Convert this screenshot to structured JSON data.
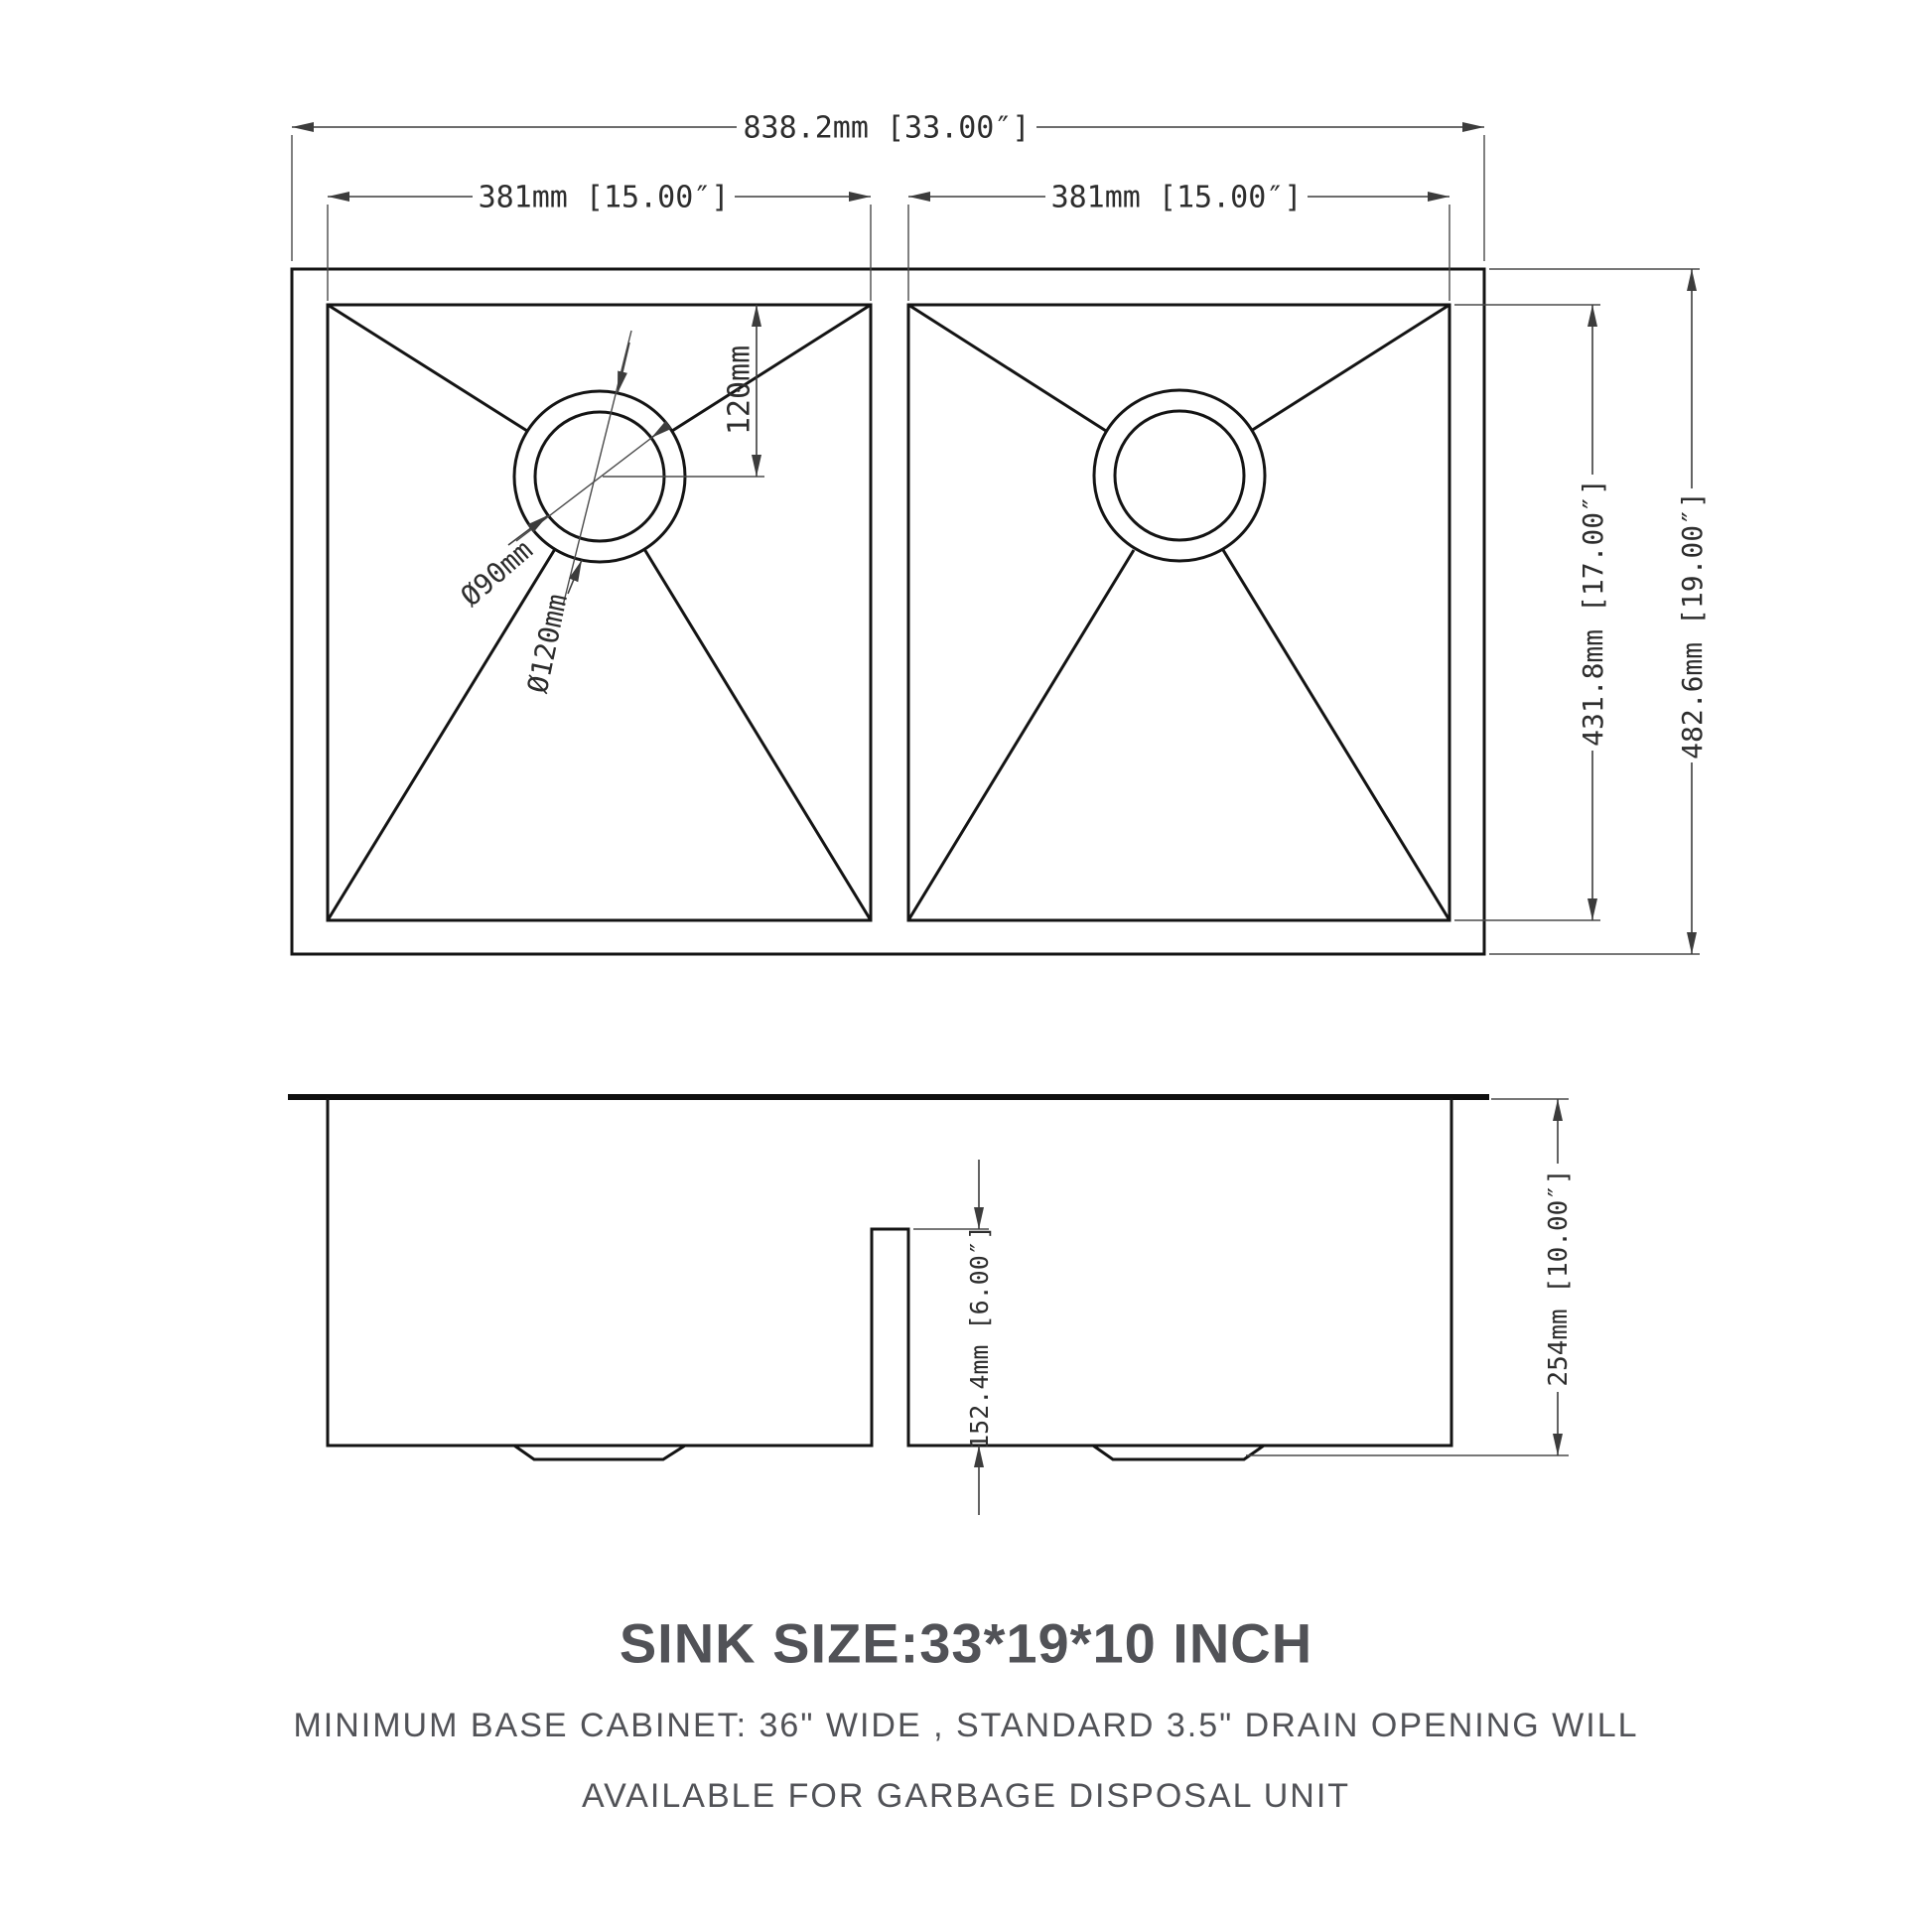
{
  "drawing_type": "sink technical drawing",
  "top_view": {
    "overall_width": "838.2mm [33.00″]",
    "bowl_width_left": "381mm [15.00″]",
    "bowl_width_right": "381mm [15.00″]",
    "drain_offset": "120mm",
    "drain_inner_dia": "Ø90mm",
    "drain_outer_dia": "Ø120mm",
    "bowl_depth": "431.8mm [17.00″]",
    "overall_depth": "482.6mm [19.00″]"
  },
  "side_view": {
    "divider_height": "152.4mm [6.00″]",
    "overall_height": "254mm [10.00″]"
  },
  "caption": {
    "title": "SINK SIZE:33*19*10 INCH",
    "line1": "MINIMUM BASE CABINET: 36\" WIDE , STANDARD 3.5\" DRAIN OPENING WILL",
    "line2": "AVAILABLE FOR GARBAGE DISPOSAL UNIT"
  },
  "colors": {
    "geometry_line": "#141414",
    "dimension_line": "#3c3c3c",
    "caption_text": "#515257",
    "background": "#ffffff"
  }
}
